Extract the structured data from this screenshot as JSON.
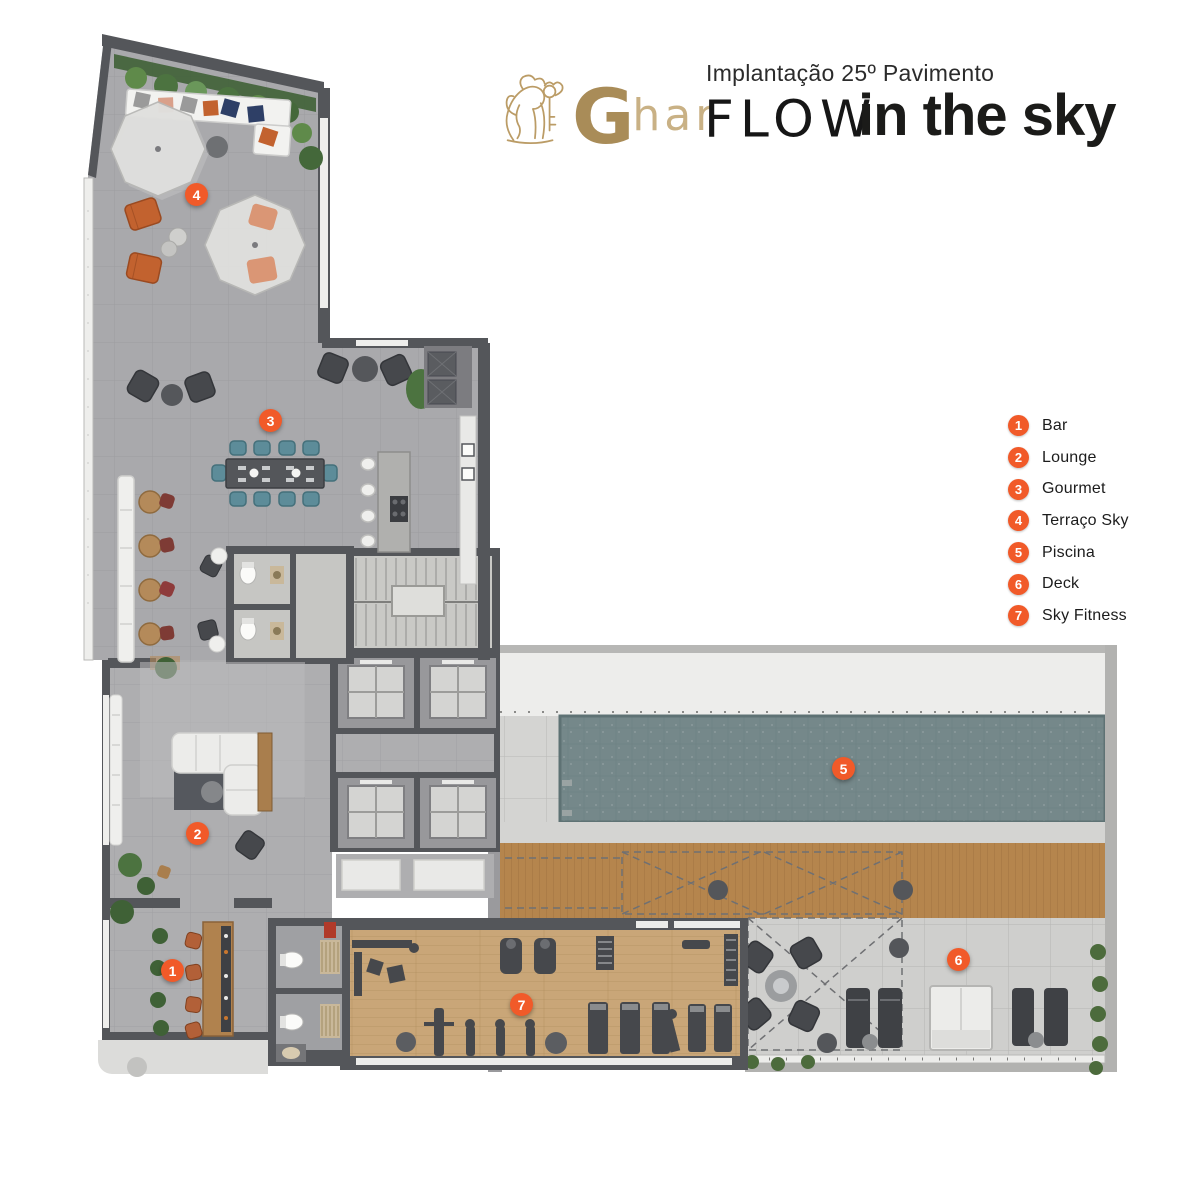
{
  "header": {
    "brand_g": "G",
    "brand_rest": "har",
    "subtitle": "Implantação 25º Pavimento",
    "logo_flow": "FLOW",
    "logo_tagline": "in the sky"
  },
  "legend": {
    "items": [
      {
        "number": "1",
        "label": "Bar"
      },
      {
        "number": "2",
        "label": "Lounge"
      },
      {
        "number": "3",
        "label": "Gourmet"
      },
      {
        "number": "4",
        "label": "Terraço Sky"
      },
      {
        "number": "5",
        "label": "Piscina"
      },
      {
        "number": "6",
        "label": "Deck"
      },
      {
        "number": "7",
        "label": "Sky Fitness"
      }
    ]
  },
  "icons": {
    "lion": "ghar-lion-logo-icon"
  },
  "colors": {
    "accent_orange": "#f15a29",
    "brand_gold": "#b2955f",
    "logo_black": "#1b1b19",
    "wall_gray": "#54565a",
    "paving_gray": "#a9a9ac",
    "pool_teal": "#75888a",
    "deck_wood": "#b5854d",
    "fitness_wood": "#c9a678"
  }
}
